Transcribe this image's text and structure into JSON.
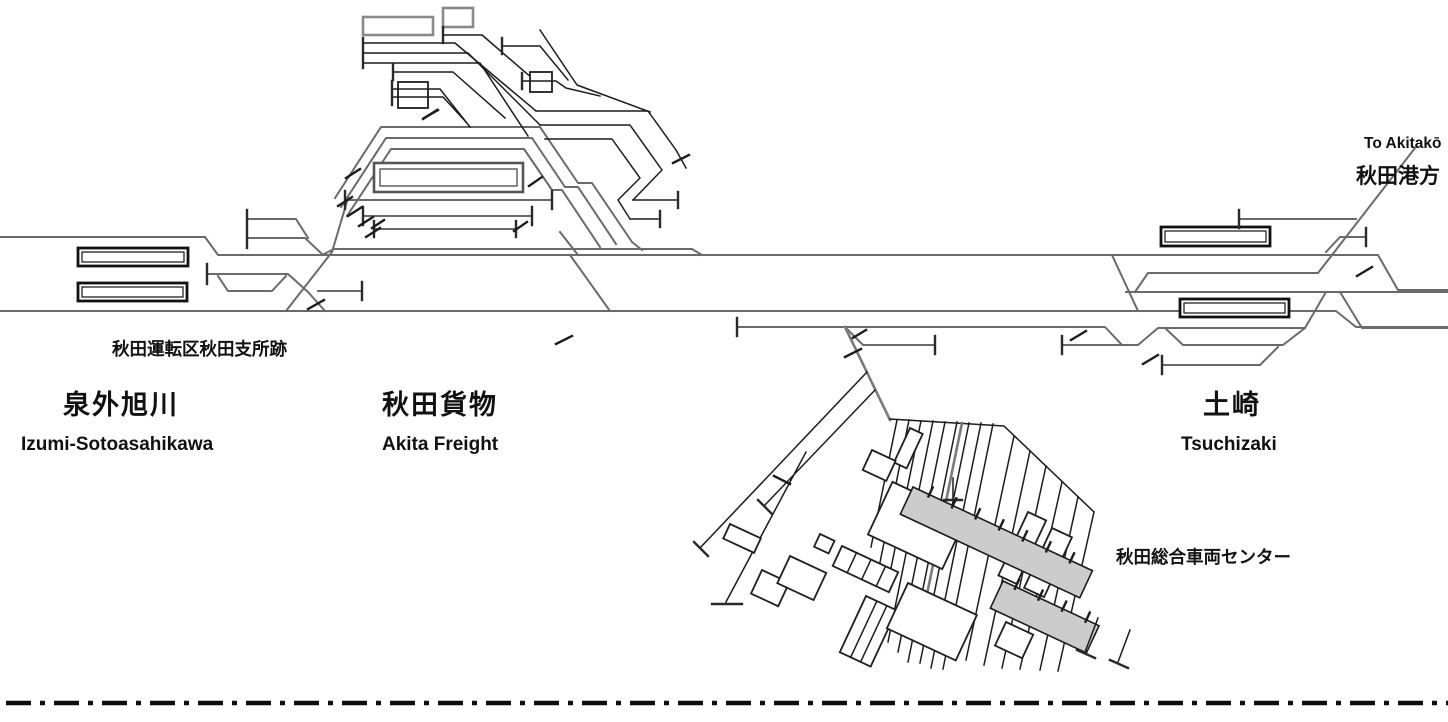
{
  "diagram": {
    "title": "Track layout around Akita Freight / Tsuchizaki",
    "stations": [
      {
        "name_ja": "泉外旭川",
        "name_en": "Izumi-Sotoasahikawa"
      },
      {
        "name_ja": "秋田貨物",
        "name_en": "Akita Freight"
      },
      {
        "name_ja": "土崎",
        "name_en": "Tsuchizaki"
      }
    ],
    "annotations": {
      "depot_site": "秋田運転区秋田支所跡",
      "to_akitako_en": "To Akitakō",
      "to_akitako_ja": "秋田港方",
      "rolling_stock_center": "秋田総合車両センター"
    },
    "colors": {
      "track": "#6a6a6a",
      "dark_track": "#1c1c1c",
      "shed_fill": "#cccccc",
      "platform_stroke": "#111111",
      "boundary": "#0d0d0d"
    }
  }
}
